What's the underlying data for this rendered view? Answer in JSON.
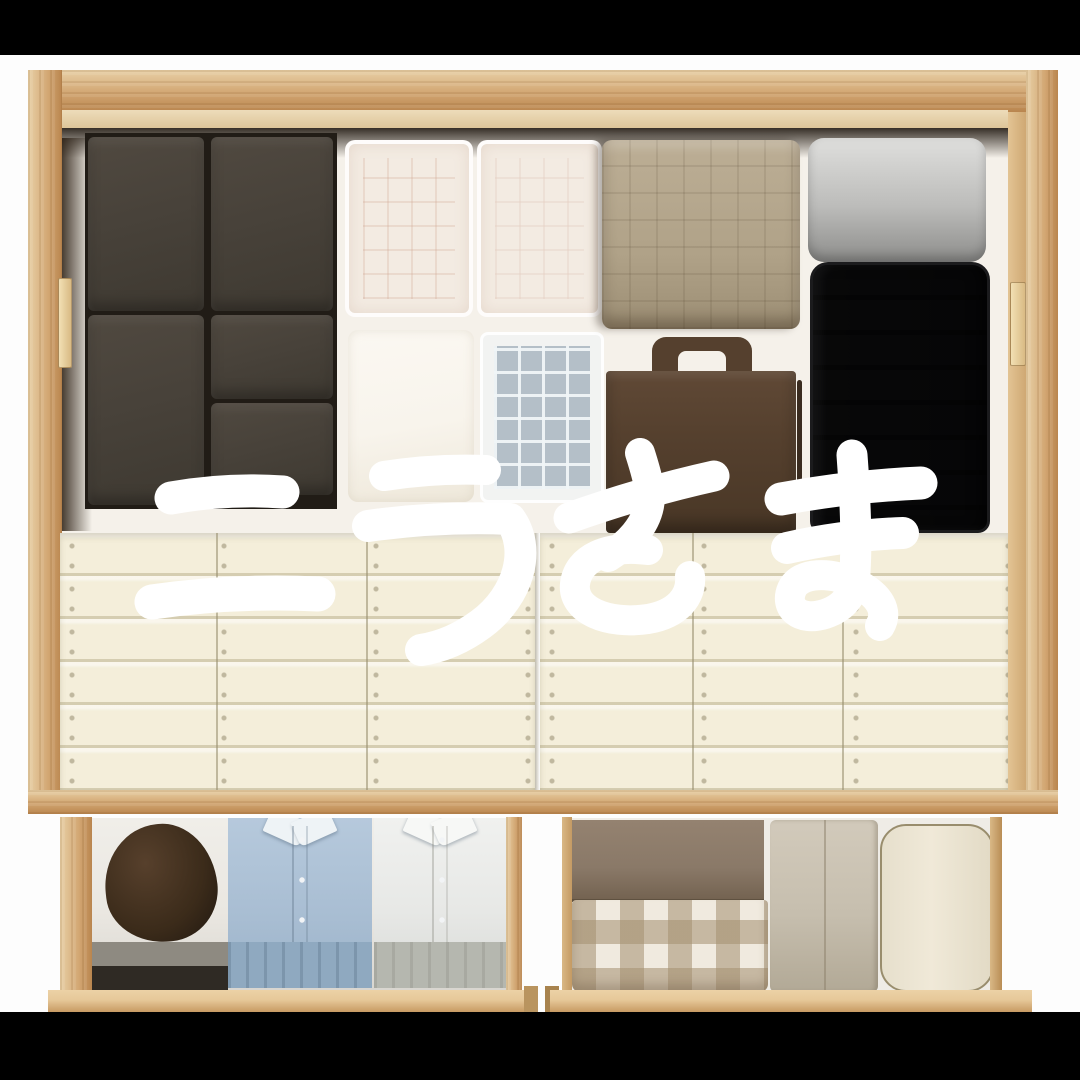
{
  "overlay": {
    "text": "ニラさま",
    "description_color": "#ffffff"
  },
  "palette": {
    "bar": "#000000",
    "photo_bg": "#fdfdfd",
    "wood": "#d2a672",
    "wood_light": "#e8d0a6",
    "wood_deep": "#b9854e",
    "interior_bg": "#f5f1ea",
    "box_dark": "#48423a",
    "box_dark_deep": "#211c16",
    "frost": "#f3ebe2",
    "white_box": "#f8f4ec",
    "grid_box_bg": "#b4bfc8",
    "blanket": "#b0a288",
    "cushion_hi": "#dadad8",
    "cushion_lo": "#8d8d8b",
    "suitcase": "#2c2c2e",
    "suitcase_rib": "#1f1f21",
    "tote": "#55402e",
    "slat": "#f4eeda",
    "slat_line": "#d5cdb1",
    "drawer_face": "#e6c899",
    "drawer_interior": "#eae7e1",
    "cap": "#3b2b1a",
    "shirt_blue": "#a9bed3",
    "shirt_blue_deep": "#8fa9c0",
    "shirt_white": "#e7e8e6",
    "shirt_white_deep": "#b5b7af",
    "band_grey": "#8e8a81",
    "band_dark": "#2f2a24",
    "towel_brown": "#8a7968",
    "gingham_bg": "#f0eadf",
    "towel_beige": "#c6beae",
    "roll": "#f0e9d8",
    "roll_edge": "#998d6d",
    "text": "#ffffff"
  }
}
